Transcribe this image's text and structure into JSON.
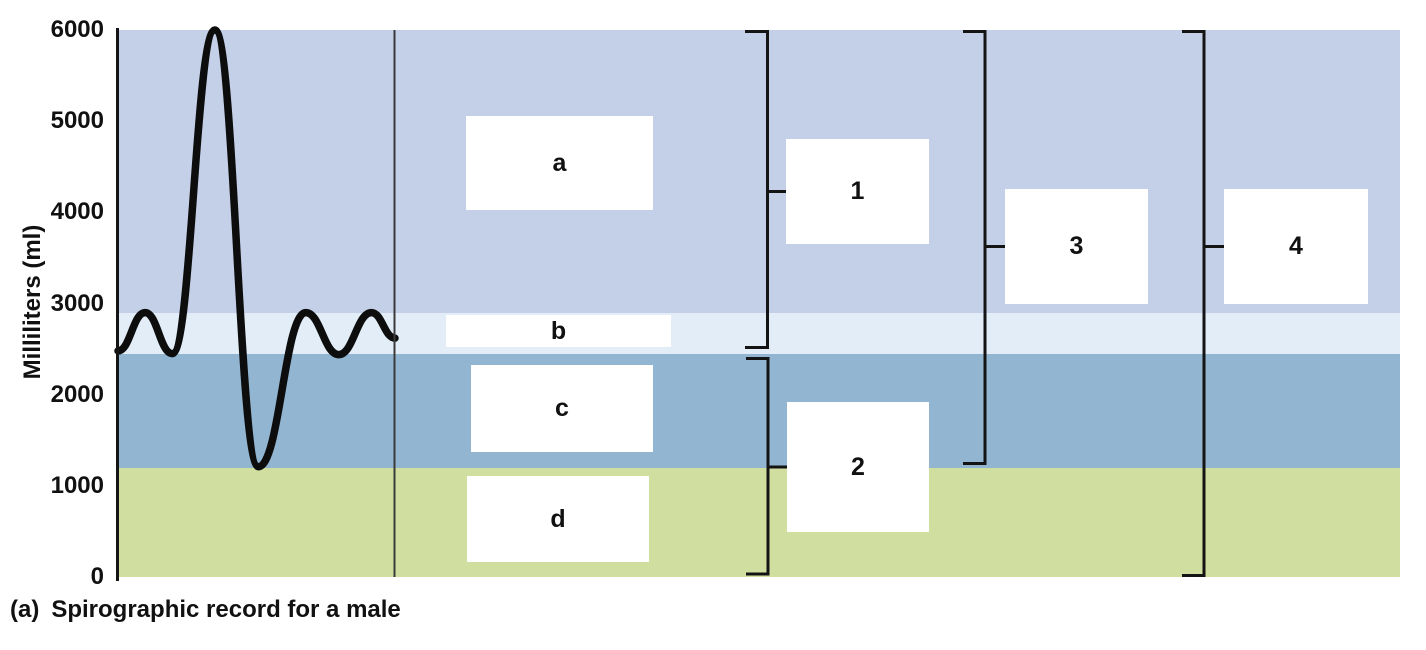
{
  "figure": {
    "caption_prefix": "(a)",
    "caption_text": "Spirographic record for a male",
    "y_axis": {
      "label": "Milliliters (ml)"
    },
    "answer_boxes": [
      {
        "id": "a",
        "label": "a"
      },
      {
        "id": "b",
        "label": "b"
      },
      {
        "id": "c",
        "label": "c"
      },
      {
        "id": "d",
        "label": "d"
      }
    ],
    "bracket_boxes": [
      {
        "id": "1",
        "label": "1",
        "spans_ml": [
          2500,
          6000
        ]
      },
      {
        "id": "2",
        "label": "2",
        "spans_ml": [
          0,
          2450
        ]
      },
      {
        "id": "3",
        "label": "3",
        "spans_ml": [
          1200,
          6000
        ]
      },
      {
        "id": "4",
        "label": "4",
        "spans_ml": [
          0,
          6000
        ]
      }
    ],
    "colors": {
      "band_top": "#c3d0e8",
      "band_tidal": "#e2edf8",
      "band_expiratory": "#92b5d2",
      "band_residual": "#d0df9f",
      "trace": "#0d0d0d",
      "bracket": "#141414",
      "axis": "#151515",
      "divider": "#3a3a3a"
    }
  },
  "chart_data": {
    "type": "line",
    "title": "Spirographic record for a male",
    "xlabel": "",
    "ylabel": "Milliliters (ml)",
    "ylim": [
      0,
      6000
    ],
    "grid": false,
    "y_ticks": [
      {
        "label": "6000",
        "value": 6000
      },
      {
        "label": "5000",
        "value": 5000
      },
      {
        "label": "4000",
        "value": 4000
      },
      {
        "label": "3000",
        "value": 3000
      },
      {
        "label": "2000",
        "value": 2000
      },
      {
        "label": "1000",
        "value": 1000
      },
      {
        "label": "0",
        "value": 0
      }
    ],
    "bands": [
      {
        "name": "inspiratory-reserve-zone",
        "from": 2900,
        "to": 6000,
        "color": "#c3d0e8"
      },
      {
        "name": "tidal-volume-zone",
        "from": 2450,
        "to": 2900,
        "color": "#e2edf8"
      },
      {
        "name": "expiratory-reserve-zone",
        "from": 1200,
        "to": 2450,
        "color": "#92b5d2"
      },
      {
        "name": "residual-volume-zone",
        "from": 0,
        "to": 1200,
        "color": "#d0df9f"
      }
    ],
    "series": [
      {
        "name": "spirogram-trace",
        "color": "#0d0d0d",
        "points": [
          {
            "f": 0.0,
            "ml": 2480
          },
          {
            "f": 0.098,
            "ml": 2900
          },
          {
            "f": 0.196,
            "ml": 2450
          },
          {
            "f": 0.35,
            "ml": 6000
          },
          {
            "f": 0.507,
            "ml": 1210
          },
          {
            "f": 0.678,
            "ml": 2900
          },
          {
            "f": 0.797,
            "ml": 2440
          },
          {
            "f": 0.915,
            "ml": 2900
          },
          {
            "f": 1.0,
            "ml": 2620
          }
        ]
      }
    ]
  }
}
